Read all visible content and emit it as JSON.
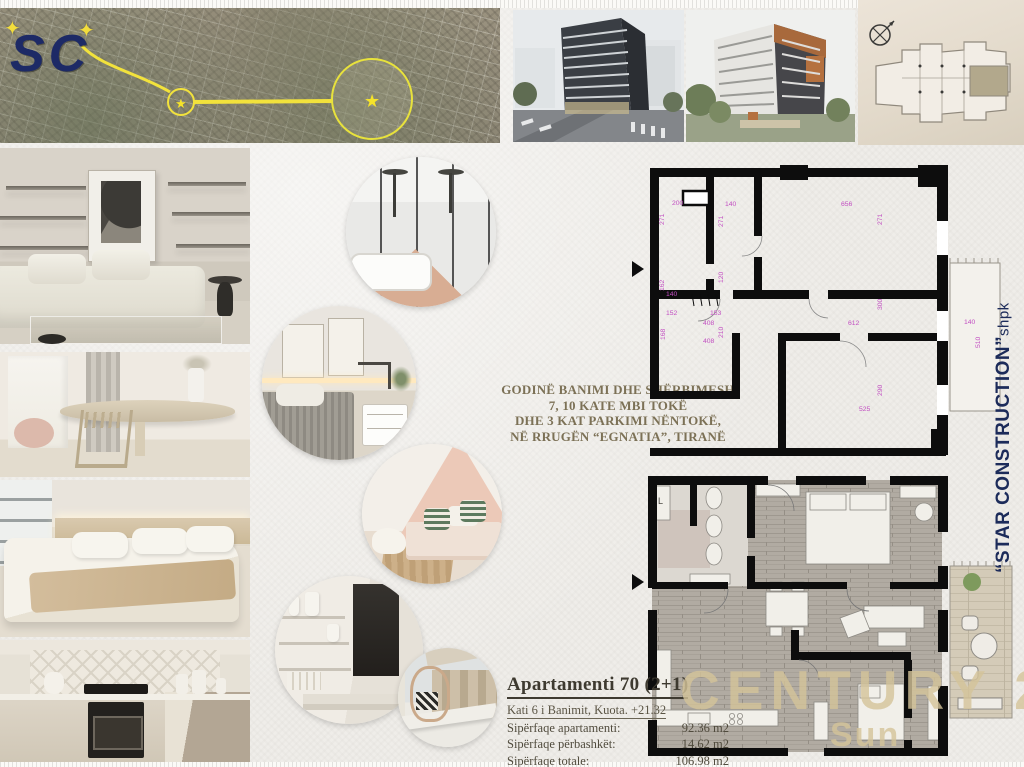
{
  "branding": {
    "map_logo": "SC",
    "developer_name": "“STAR CONSTRUCTION”",
    "developer_suffix": " shpk",
    "developer_color": "#1c2b5a",
    "watermark_primary": "CENTURY 21",
    "watermark_secondary": "Sun",
    "watermark_color": "#d5c49a"
  },
  "description": {
    "line1": "GODINË BANIMI DHE SHËRBIMESH",
    "line2": "7, 10 KATE MBI TOKË",
    "line3": "DHE 3 KAT PARKIMI NËNTOKË,",
    "line4": "NË RRUGËN “EGNATIA”, TIRANË"
  },
  "apartment": {
    "title": "Apartamenti 70  (2+1)",
    "subtitle": "Kati 6 i Banimit, Kuota. +21.32",
    "rows": [
      {
        "label": "Sipërfaqe apartamenti:",
        "value": "92.36 m2"
      },
      {
        "label": "Sipërfaqe përbashkët:",
        "value": "14.62 m2"
      },
      {
        "label": "Sipërfaqe totale:",
        "value": "106.98 m2"
      }
    ]
  },
  "plan1": {
    "dim_color": "#c24fc2",
    "dims": {
      "t200": "200",
      "t140a": "140",
      "t656": "656",
      "v271a": "271",
      "v271b": "271",
      "v271c": "271",
      "v162": "162",
      "v120": "120",
      "t140b": "140",
      "t152": "152",
      "t153": "153",
      "t408a": "408",
      "v210": "210",
      "t408b": "408",
      "v168": "168",
      "t612": "612",
      "v300": "300",
      "v290": "290",
      "t525": "525",
      "t140c": "140",
      "v510": "510"
    }
  },
  "plan2": {
    "label_l": "L"
  }
}
